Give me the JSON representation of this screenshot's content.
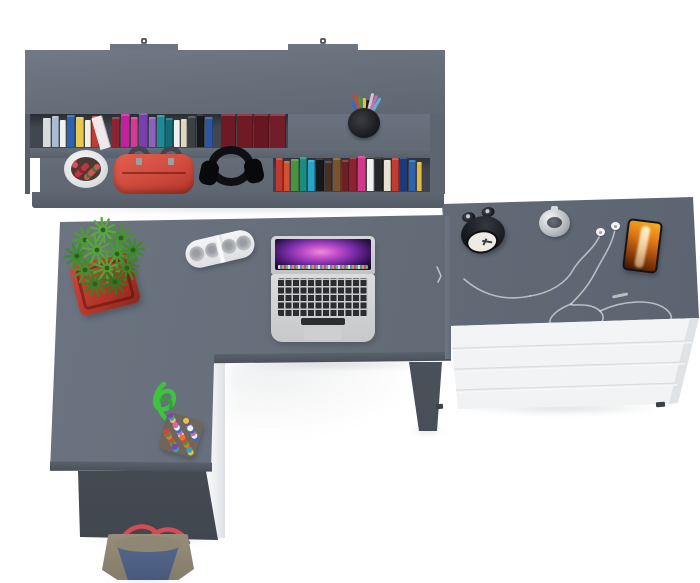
{
  "scene": {
    "title": "Top view of a grey and white corner desk set with wall shelf, laptop and drawer unit",
    "background": "#ffffff",
    "furniture_grey": "#646c78",
    "furniture_white": "#f6f7f8"
  },
  "hutch": {
    "label": "wall-shelf-unit",
    "mount_tab_count": 2,
    "row1_books": [
      {
        "c": "#d8dadc",
        "w": 8,
        "h": 29
      },
      {
        "c": "#a9bcd4",
        "w": 7,
        "h": 31
      },
      {
        "c": "#f1f1ef",
        "w": 6,
        "h": 27
      },
      {
        "c": "#2e62ad",
        "w": 8,
        "h": 32
      },
      {
        "c": "#e4c94e",
        "w": 8,
        "h": 30
      },
      {
        "c": "#f3efe3",
        "w": 6,
        "h": 27
      },
      {
        "c": "#c23b32",
        "w": 7,
        "h": 31
      },
      {
        "c": "#f0e9ec",
        "w": 11,
        "h": 33,
        "t": -16
      },
      {
        "c": "#8c2330",
        "w": 8,
        "h": 30
      },
      {
        "c": "#c2219c",
        "w": 9,
        "h": 33
      },
      {
        "c": "#d23a93",
        "w": 7,
        "h": 30
      },
      {
        "c": "#7a3fae",
        "w": 9,
        "h": 34
      },
      {
        "c": "#8a63c0",
        "w": 7,
        "h": 30
      },
      {
        "c": "#1f8a96",
        "w": 8,
        "h": 32
      },
      {
        "c": "#156b77",
        "w": 7,
        "h": 29
      },
      {
        "c": "#eff0f0",
        "w": 6,
        "h": 27
      },
      {
        "c": "#e0d7bf",
        "w": 6,
        "h": 28
      },
      {
        "c": "#3c4043",
        "w": 8,
        "h": 31
      },
      {
        "c": "#17181a",
        "w": 7,
        "h": 33
      },
      {
        "c": "#2d55a0",
        "w": 8,
        "h": 30
      }
    ],
    "maroon_books": [
      {
        "c": "#6e1a26",
        "w": 15,
        "h": 34,
        "p": 1
      },
      {
        "c": "#701b24",
        "w": 16,
        "h": 34,
        "p": 1
      },
      {
        "c": "#671722",
        "w": 15,
        "h": 34,
        "p": 1
      },
      {
        "c": "#721d28",
        "w": 16,
        "h": 34,
        "p": 1
      }
    ],
    "row2_books": [
      {
        "c": "#c0392e",
        "w": 7,
        "h": 33
      },
      {
        "c": "#d4502f",
        "w": 6,
        "h": 30
      },
      {
        "c": "#4a9140",
        "w": 8,
        "h": 32
      },
      {
        "c": "#1f8a80",
        "w": 7,
        "h": 34
      },
      {
        "c": "#2aa3c8",
        "w": 7,
        "h": 31
      },
      {
        "c": "#17181b",
        "w": 8,
        "h": 33
      },
      {
        "c": "#4a3020",
        "w": 7,
        "h": 30
      },
      {
        "c": "#7a5230",
        "w": 8,
        "h": 33
      },
      {
        "c": "#6e1f26",
        "w": 7,
        "h": 31
      },
      {
        "c": "#8c2330",
        "w": 7,
        "h": 34
      },
      {
        "c": "#d23a85",
        "w": 8,
        "h": 35
      },
      {
        "c": "#f0f0ee",
        "w": 7,
        "h": 32
      },
      {
        "c": "#232528",
        "w": 8,
        "h": 34
      },
      {
        "c": "#e8e2d2",
        "w": 7,
        "h": 31
      },
      {
        "c": "#c23b32",
        "w": 7,
        "h": 33
      },
      {
        "c": "#1f3a7a",
        "w": 8,
        "h": 34
      },
      {
        "c": "#2f63ae",
        "w": 7,
        "h": 31
      },
      {
        "c": "#e0b93f",
        "w": 5,
        "h": 29
      }
    ],
    "pen_colors": [
      "#2f6fbe",
      "#d8423a",
      "#3f9a3f",
      "#e8c23f",
      "#1a1b1e",
      "#c8cacd",
      "#d864b0",
      "#50b8d8"
    ]
  },
  "shelf_items": {
    "flower_pot": {
      "pot": "#eef0f1",
      "soil": "#4c3a32",
      "bloom_dots": {
        "colors": [
          "#c13540",
          "#d8505a",
          "#8f1f2c",
          "#3f7a33",
          "#c13540",
          "#d8505a"
        ],
        "count": 14,
        "size": 6
      }
    },
    "red_bag": {
      "body": "#cf4a3d",
      "handles": "#42464e"
    },
    "headphones": {
      "color": "#0e0f12"
    }
  },
  "desk": {
    "label": "l-shaped-desk",
    "plant": {
      "pot_color": "#b23528",
      "rosettes": [
        {
          "x": 30,
          "y": 28,
          "r": 13,
          "c": "#4f9a35"
        },
        {
          "x": 48,
          "y": 18,
          "r": 12,
          "c": "#5aa83e"
        },
        {
          "x": 66,
          "y": 26,
          "r": 13,
          "c": "#479231"
        },
        {
          "x": 22,
          "y": 44,
          "r": 12,
          "c": "#3f8a2c"
        },
        {
          "x": 42,
          "y": 38,
          "r": 14,
          "c": "#57a53c"
        },
        {
          "x": 62,
          "y": 42,
          "r": 13,
          "c": "#4a9a33"
        },
        {
          "x": 78,
          "y": 38,
          "r": 11,
          "c": "#3f8a2c"
        },
        {
          "x": 30,
          "y": 58,
          "r": 13,
          "c": "#449130"
        },
        {
          "x": 52,
          "y": 56,
          "r": 14,
          "c": "#52a038"
        },
        {
          "x": 72,
          "y": 56,
          "r": 12,
          "c": "#3d852a"
        },
        {
          "x": 40,
          "y": 72,
          "r": 12,
          "c": "#3a7f27"
        },
        {
          "x": 60,
          "y": 70,
          "r": 12,
          "c": "#357423"
        }
      ]
    },
    "speaker": {
      "body": "#f1f2f2",
      "grille": "#9aa0a6",
      "grille_count": 4
    },
    "laptop": {
      "body": "#d7d9db",
      "keys": "#2b2d31",
      "wallpaper": "pink-purple-aurora"
    }
  },
  "dresser": {
    "label": "four-drawer-unit",
    "drawer_count": 4,
    "clock": {
      "body": "#16181c",
      "face": "#edebe4"
    },
    "chrome_watch": {
      "color": "#b9bdc2"
    },
    "earbuds": {
      "color": "#f2f3f4"
    },
    "phone": {
      "body": "#141518",
      "screen": "#e0761a"
    }
  },
  "floor_items": {
    "stool": {
      "fiber": "#b78f4e",
      "mat": "#34373d"
    },
    "pom_bag": {
      "rope": "#3fc33f",
      "bag": "#6e665c",
      "dots": {
        "colors": [
          "#d8423a",
          "#2f6fbe",
          "#e8c23f",
          "#3f9a3f",
          "#d864b0",
          "#8a3fae",
          "#e07828",
          "#f2f2f0",
          "#2aa3c8"
        ],
        "count": 46,
        "size": 6
      }
    },
    "tote_bag": {
      "canvas": "#8f8774",
      "denim": "#50648a",
      "straps": "#d84b55"
    }
  }
}
